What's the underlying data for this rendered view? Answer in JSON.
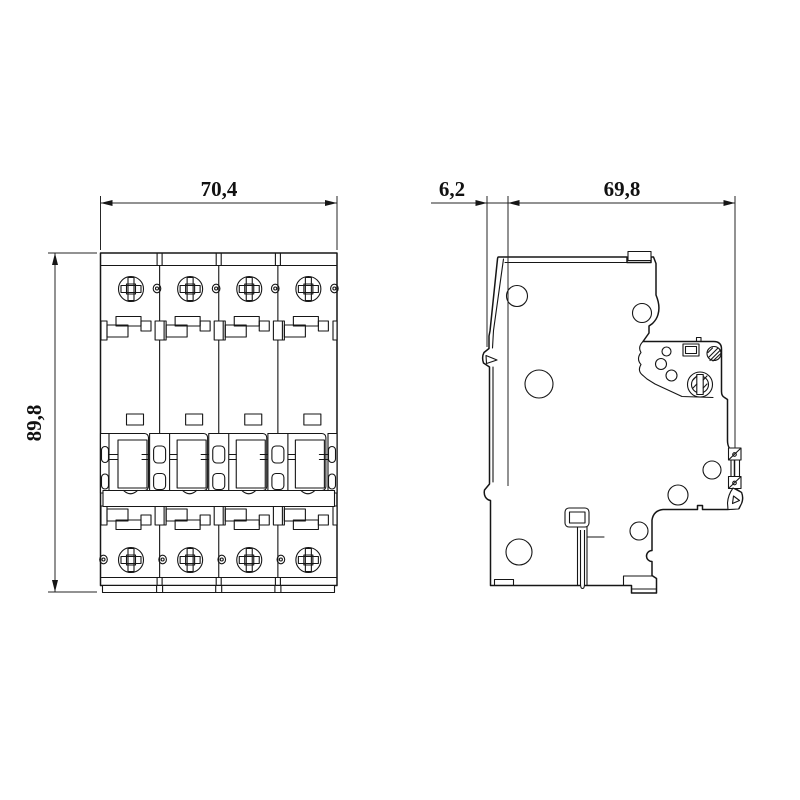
{
  "page": {
    "background": "#ffffff",
    "line_color": "#161616",
    "description_icons": {
      "phillips_screw": "screw-head-icon",
      "terminal_clamp_screw": "clamp-screw-icon",
      "din_latch": "din-rail-latch-icon"
    }
  },
  "front_view": {
    "pole_count": 4,
    "width_label": "70,4",
    "height_label": "89,8"
  },
  "side_view": {
    "offset_label": "6,2",
    "depth_label": "69,8"
  }
}
